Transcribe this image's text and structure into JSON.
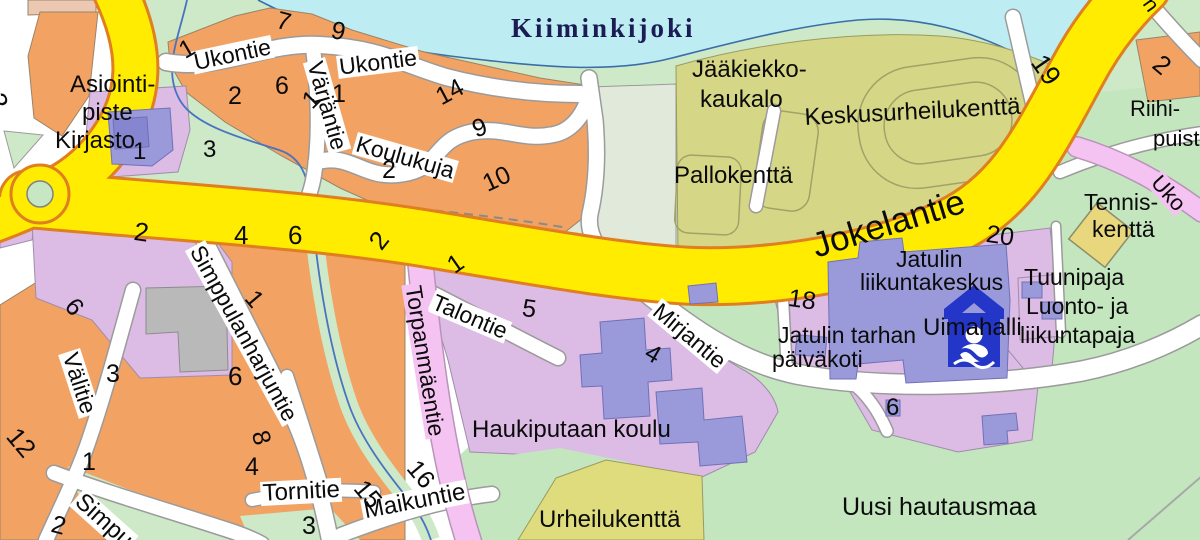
{
  "palette": {
    "water": "#bdedf3",
    "river_label_navy": "#1c1c55",
    "stream_blue": "#4a72c0",
    "park_green": "#cde9c8",
    "cemetery_green": "#c3e6bf",
    "sports_olive": "#d6d786",
    "field_yellow_green": "#dedc7c",
    "pale_field": "#e0e9da",
    "residential_orange": "#f2a263",
    "tan_block": "#ecc7b1",
    "public_purple": "#dcbbe4",
    "building_blue": "#9a9ada",
    "building_gray": "#b9b9b9",
    "road_yellow": "#ffec00",
    "road_yellow_casing": "#e07f1f",
    "road_white": "#ffffff",
    "road_casing": "#9b9b9b",
    "road_pink": "#f5c3f1",
    "road_pink_casing": "#b894b8",
    "court_yellow": "#e9d77e",
    "icon_blue": "#2336c8",
    "label_black": "#0b0b0b"
  },
  "icons": [
    {
      "name": "swimming-hall-icon"
    }
  ],
  "labels": [
    {
      "t": "Kiiminkijoki",
      "x": 511,
      "y": 15,
      "s": 27,
      "k": "river"
    },
    {
      "t": "Asiointi-",
      "x": 70,
      "y": 73,
      "s": 24,
      "k": "a"
    },
    {
      "t": "piste",
      "x": 82,
      "y": 101,
      "s": 24,
      "k": "a"
    },
    {
      "t": "Kirjasto",
      "x": 55,
      "y": 129,
      "s": 24,
      "k": "a"
    },
    {
      "t": "1",
      "x": 133,
      "y": 140,
      "s": 24,
      "k": "n"
    },
    {
      "t": "Ukontie",
      "x": 190,
      "y": 52,
      "r": -12,
      "s": 23,
      "k": "s"
    },
    {
      "t": "Ukontie",
      "x": 336,
      "y": 56,
      "r": -7,
      "s": 23,
      "k": "s"
    },
    {
      "t": "Värjäntie",
      "x": 325,
      "y": 57,
      "r": 74,
      "s": 23,
      "k": "s"
    },
    {
      "t": "Koulukuja",
      "x": 358,
      "y": 132,
      "r": 16,
      "s": 23,
      "k": "s"
    },
    {
      "t": "1",
      "x": 175,
      "y": 42,
      "r": -30,
      "s": 25,
      "k": "n"
    },
    {
      "t": "7",
      "x": 280,
      "y": 8,
      "r": 15,
      "s": 25,
      "k": "n"
    },
    {
      "t": "9",
      "x": 334,
      "y": 18,
      "r": 12,
      "s": 25,
      "k": "n"
    },
    {
      "t": "2",
      "x": 228,
      "y": 84,
      "s": 25,
      "k": "n"
    },
    {
      "t": "6",
      "x": 275,
      "y": 74,
      "s": 25,
      "k": "n"
    },
    {
      "t": "1",
      "x": 298,
      "y": 96,
      "r": -45,
      "s": 25,
      "k": "n"
    },
    {
      "t": "1",
      "x": 332,
      "y": 82,
      "s": 25,
      "k": "n"
    },
    {
      "t": "14",
      "x": 432,
      "y": 88,
      "r": -28,
      "s": 25,
      "k": "n"
    },
    {
      "t": "9",
      "x": 469,
      "y": 119,
      "r": -20,
      "s": 25,
      "k": "n"
    },
    {
      "t": "2",
      "x": 382,
      "y": 158,
      "s": 25,
      "k": "n"
    },
    {
      "t": "10",
      "x": 479,
      "y": 174,
      "r": -25,
      "s": 25,
      "k": "n"
    },
    {
      "t": "3",
      "x": 203,
      "y": 138,
      "s": 24,
      "k": "n"
    },
    {
      "t": "2",
      "x": 8,
      "y": 90,
      "r": 75,
      "s": 27,
      "k": "n"
    },
    {
      "t": "Jääkiekko-",
      "x": 692,
      "y": 58,
      "s": 24,
      "k": "a"
    },
    {
      "t": "kaukalo",
      "x": 700,
      "y": 88,
      "s": 24,
      "k": "a"
    },
    {
      "t": "Keskusurheilukenttä",
      "x": 804,
      "y": 106,
      "r": -3,
      "s": 24,
      "k": "a"
    },
    {
      "t": "Pallokenttä",
      "x": 674,
      "y": 164,
      "s": 24,
      "k": "a"
    },
    {
      "t": "19",
      "x": 1048,
      "y": 50,
      "r": 55,
      "s": 27,
      "k": "n"
    },
    {
      "t": "2",
      "x": 1165,
      "y": 50,
      "r": 40,
      "s": 26,
      "k": "n"
    },
    {
      "t": "Riihi-",
      "x": 1130,
      "y": 98,
      "s": 22,
      "k": "a"
    },
    {
      "t": "puist",
      "x": 1153,
      "y": 128,
      "s": 22,
      "k": "a"
    },
    {
      "t": "n",
      "x": 1156,
      "y": -6,
      "r": 55,
      "s": 21,
      "k": "p"
    },
    {
      "t": "Uko",
      "x": 1162,
      "y": 170,
      "r": 48,
      "s": 22,
      "k": "sp"
    },
    {
      "t": "Tennis-",
      "x": 1084,
      "y": 191,
      "s": 23,
      "k": "a"
    },
    {
      "t": "kenttä",
      "x": 1092,
      "y": 218,
      "s": 23,
      "k": "a"
    },
    {
      "t": "Jokelantie",
      "x": 808,
      "y": 230,
      "r": -17,
      "s": 35,
      "k": "sy"
    },
    {
      "t": "20",
      "x": 988,
      "y": 222,
      "r": 8,
      "s": 25,
      "k": "n"
    },
    {
      "t": "Jatulin",
      "x": 896,
      "y": 248,
      "s": 23,
      "k": "a"
    },
    {
      "t": "liikuntakeskus",
      "x": 860,
      "y": 271,
      "s": 23,
      "k": "a"
    },
    {
      "t": "Tuunipaja",
      "x": 1024,
      "y": 266,
      "s": 23,
      "k": "a"
    },
    {
      "t": "Luonto- ja",
      "x": 1026,
      "y": 295,
      "s": 23,
      "k": "a"
    },
    {
      "t": "liikuntapaja",
      "x": 1020,
      "y": 324,
      "s": 23,
      "k": "a"
    },
    {
      "t": "Uimahalli",
      "x": 923,
      "y": 316,
      "s": 24,
      "k": "a"
    },
    {
      "t": "18",
      "x": 790,
      "y": 286,
      "r": 8,
      "s": 25,
      "k": "n"
    },
    {
      "t": "Jatulin tarhan",
      "x": 778,
      "y": 324,
      "s": 23,
      "k": "a"
    },
    {
      "t": "päiväkoti",
      "x": 772,
      "y": 348,
      "s": 23,
      "k": "a"
    },
    {
      "t": "Mirjantie",
      "x": 662,
      "y": 298,
      "r": 40,
      "s": 23,
      "k": "s"
    },
    {
      "t": "4",
      "x": 653,
      "y": 340,
      "r": 30,
      "s": 25,
      "k": "n"
    },
    {
      "t": "Talontie",
      "x": 436,
      "y": 290,
      "r": 23,
      "s": 23,
      "k": "s"
    },
    {
      "t": "1",
      "x": 443,
      "y": 258,
      "r": -35,
      "s": 25,
      "k": "n"
    },
    {
      "t": "5",
      "x": 524,
      "y": 296,
      "r": 8,
      "s": 25,
      "k": "n"
    },
    {
      "t": "Torpanmäentie",
      "x": 424,
      "y": 282,
      "r": 81,
      "s": 23,
      "k": "sp"
    },
    {
      "t": "Haukiputaan koulu",
      "x": 472,
      "y": 418,
      "s": 24,
      "k": "a"
    },
    {
      "t": "Urheilukenttä",
      "x": 539,
      "y": 508,
      "s": 24,
      "k": "a"
    },
    {
      "t": "Maikuntie",
      "x": 360,
      "y": 500,
      "r": -11,
      "s": 24,
      "k": "s"
    },
    {
      "t": "16",
      "x": 421,
      "y": 456,
      "r": 50,
      "s": 25,
      "k": "n"
    },
    {
      "t": "15",
      "x": 368,
      "y": 476,
      "r": 50,
      "s": 25,
      "k": "n"
    },
    {
      "t": "Tornitie",
      "x": 260,
      "y": 482,
      "r": -3,
      "s": 24,
      "k": "s"
    },
    {
      "t": "3",
      "x": 302,
      "y": 514,
      "s": 25,
      "k": "n"
    },
    {
      "t": "8",
      "x": 271,
      "y": 428,
      "r": 75,
      "s": 25,
      "k": "n"
    },
    {
      "t": "4",
      "x": 245,
      "y": 455,
      "s": 25,
      "k": "n"
    },
    {
      "t": "Simpu",
      "x": 85,
      "y": 488,
      "r": 42,
      "s": 24,
      "k": "s"
    },
    {
      "t": "2",
      "x": 55,
      "y": 512,
      "r": 15,
      "s": 25,
      "k": "n"
    },
    {
      "t": "1",
      "x": 82,
      "y": 450,
      "s": 25,
      "k": "n"
    },
    {
      "t": "12",
      "x": 22,
      "y": 423,
      "r": 50,
      "s": 26,
      "k": "n"
    },
    {
      "t": "Välitie",
      "x": 80,
      "y": 348,
      "r": 72,
      "s": 23,
      "k": "s"
    },
    {
      "t": "3",
      "x": 106,
      "y": 362,
      "s": 25,
      "k": "n"
    },
    {
      "t": "6",
      "x": 79,
      "y": 294,
      "r": 50,
      "s": 25,
      "k": "n"
    },
    {
      "t": "2",
      "x": 136,
      "y": 218,
      "r": 8,
      "s": 26,
      "k": "n"
    },
    {
      "t": "4",
      "x": 234,
      "y": 222,
      "s": 26,
      "k": "n"
    },
    {
      "t": "6",
      "x": 288,
      "y": 222,
      "s": 26,
      "k": "n"
    },
    {
      "t": "2",
      "x": 364,
      "y": 238,
      "r": -52,
      "s": 26,
      "k": "n"
    },
    {
      "t": "Simppulanharjuntie",
      "x": 205,
      "y": 240,
      "r": 61,
      "s": 23,
      "k": "s"
    },
    {
      "t": "1",
      "x": 259,
      "y": 286,
      "r": 50,
      "s": 25,
      "k": "n"
    },
    {
      "t": "6",
      "x": 228,
      "y": 363,
      "s": 26,
      "k": "n"
    },
    {
      "t": "6",
      "x": 886,
      "y": 396,
      "s": 24,
      "k": "n"
    },
    {
      "t": "Uusi hautausmaa",
      "x": 842,
      "y": 495,
      "s": 25,
      "k": "a"
    }
  ]
}
